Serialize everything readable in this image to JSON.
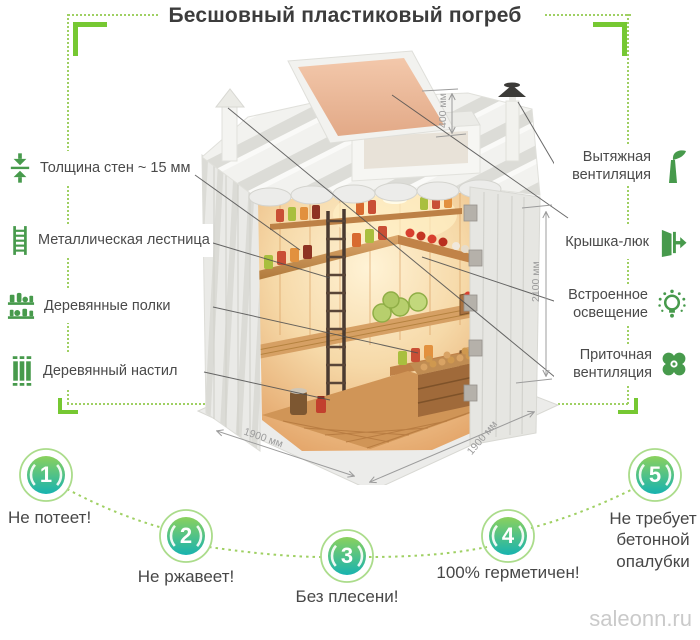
{
  "title": "Бесшовный пластиковый погреб",
  "features_left": [
    {
      "label": "Толщина стен ~ 15 мм",
      "icon": "wall-thickness-icon"
    },
    {
      "label": "Металлическая лестница",
      "icon": "ladder-icon"
    },
    {
      "label": "Деревянные полки",
      "icon": "shelves-icon"
    },
    {
      "label": "Деревянный настил",
      "icon": "decking-icon"
    }
  ],
  "features_right": [
    {
      "label": "Вытяжная вентиляция",
      "icon": "exhaust-vent-icon"
    },
    {
      "label": "Крышка-люк",
      "icon": "hatch-door-icon"
    },
    {
      "label": "Встроенное освещение",
      "icon": "light-bulb-icon"
    },
    {
      "label": "Приточная вентиляция",
      "icon": "fan-icon"
    }
  ],
  "dimensions": {
    "hatch_height": "400 мм",
    "body_height": "2100 мм",
    "depth": "1900 мм",
    "width": "1900 мм"
  },
  "benefits": [
    {
      "number": "1",
      "label": "Не потеет!"
    },
    {
      "number": "2",
      "label": "Не ржавеет!"
    },
    {
      "number": "3",
      "label": "Без плесени!"
    },
    {
      "number": "4",
      "label": "100% герметичен!"
    },
    {
      "number": "5",
      "label": "Не требует бетонной опалубки"
    }
  ],
  "watermark": "saleonn.ru",
  "colors": {
    "accent_green": "#479a4c",
    "bright_green": "#76c832",
    "dotted_green": "#9fd063",
    "badge_gradient_top": "#8bd15d",
    "badge_gradient_bottom": "#17b3b0",
    "text_dark": "#3c3c3c",
    "dimension_gray": "#9c9c9c"
  }
}
